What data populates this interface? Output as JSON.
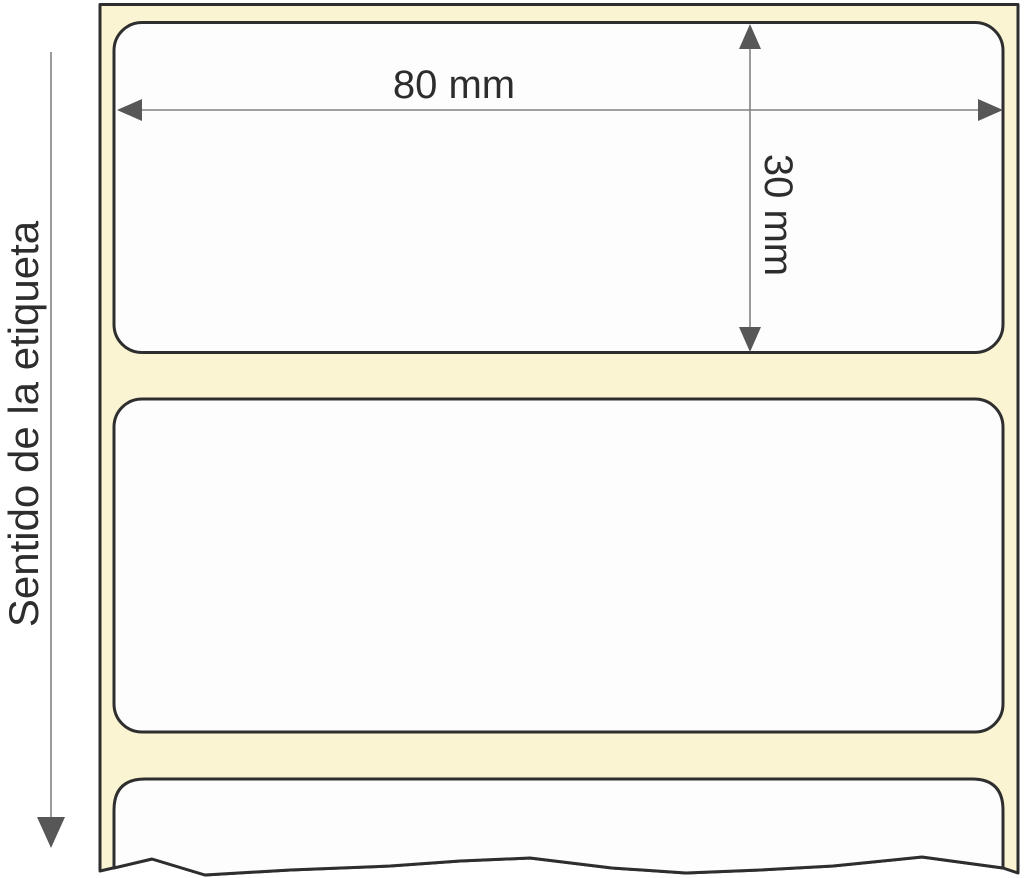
{
  "diagram": {
    "direction_label": "Sentido de la etiqueta",
    "width_dimension_label": "80 mm",
    "height_dimension_label": "30 mm",
    "colors": {
      "liner": "#faf4d3",
      "label_fill": "#fdfdfd",
      "outline": "#2e2e2e",
      "dimension_line": "#828282",
      "arrow_fill": "#575757",
      "text_color": "#2d2d2d"
    }
  }
}
